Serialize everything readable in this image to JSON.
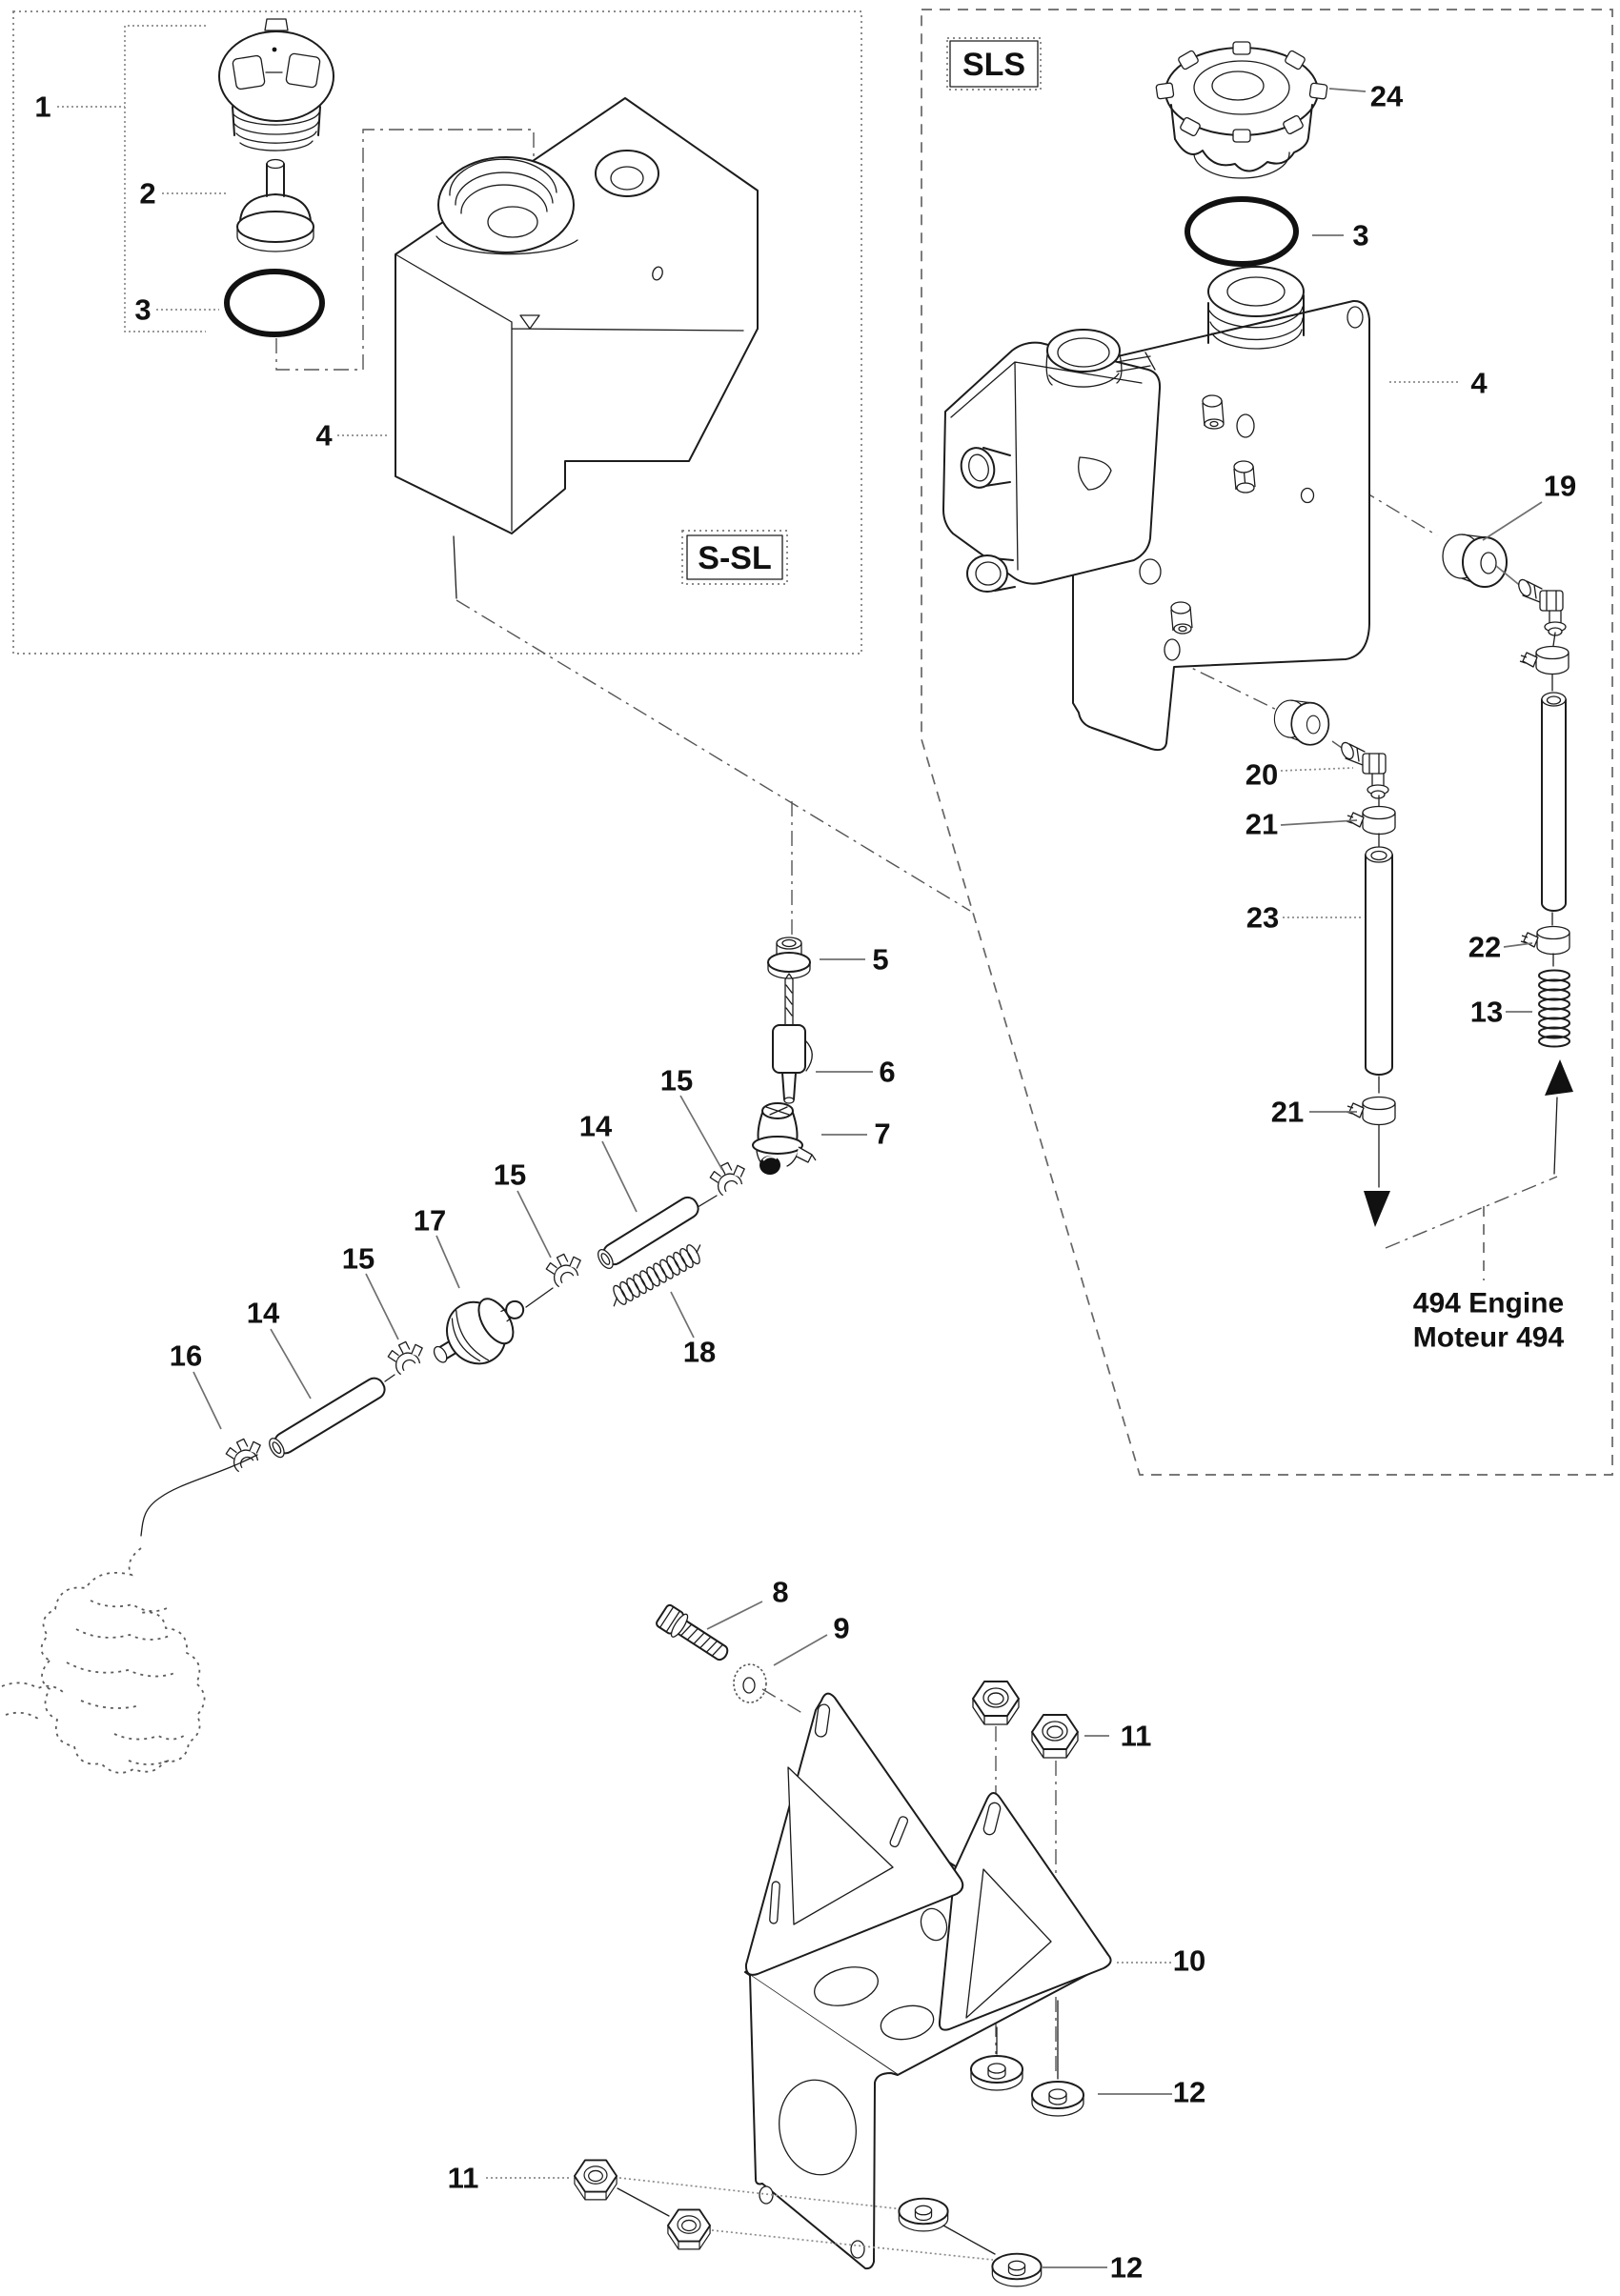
{
  "figure": {
    "type": "exploded-parts-diagram",
    "variant_labels": {
      "s_sl": "S-SL",
      "sls": "SLS"
    },
    "engine_note": {
      "line1": "494 Engine",
      "line2": "Moteur 494"
    },
    "callouts": {
      "1": "1",
      "2": "2",
      "3": "3",
      "4": "4",
      "5": "5",
      "6": "6",
      "7": "7",
      "8": "8",
      "9": "9",
      "10": "10",
      "11": "11",
      "12": "12",
      "13": "13",
      "14": "14",
      "15": "15",
      "16": "16",
      "17": "17",
      "18": "18",
      "19": "19",
      "20": "20",
      "21": "21",
      "22": "22",
      "23": "23",
      "24": "24"
    }
  }
}
